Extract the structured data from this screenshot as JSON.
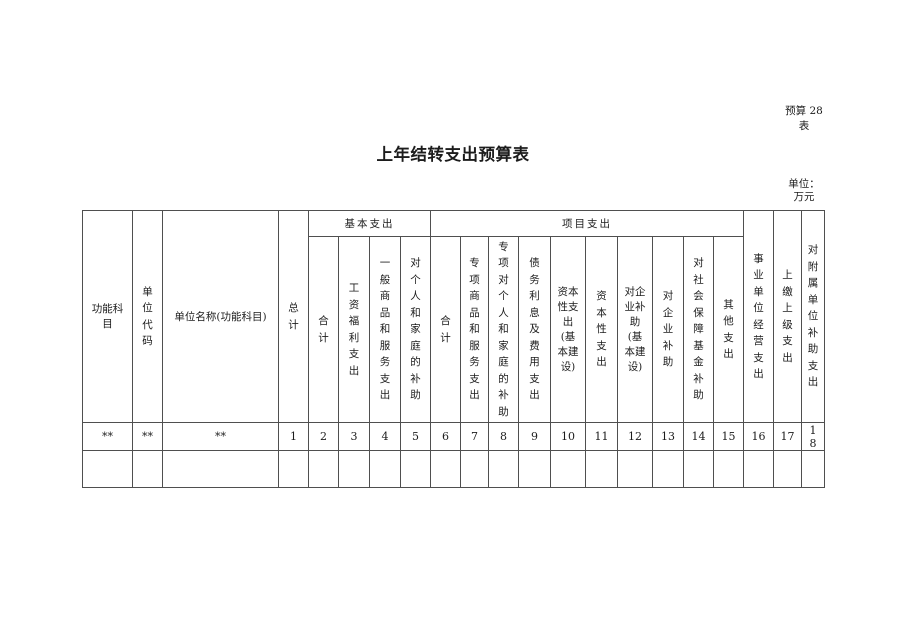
{
  "page": {
    "form_note": {
      "line1": "预算 28",
      "line2": "表"
    },
    "title": "上年结转支出预算表",
    "unit_note": {
      "line1": "单位：",
      "line2": "万元"
    }
  },
  "table": {
    "columns": [
      {
        "name": "functional-subject",
        "label": "功能科目",
        "orient": "wrap",
        "wrap_em": 3.3,
        "width": 50,
        "group": "",
        "group_id": ""
      },
      {
        "name": "unit-code",
        "label": "单位代码",
        "orient": "vertical",
        "width": 30,
        "group": "",
        "group_id": ""
      },
      {
        "name": "unit-name",
        "label": "单位名称(功能科目)",
        "orient": "horizontal",
        "width": 116,
        "group": "",
        "group_id": ""
      },
      {
        "name": "grand-total",
        "label": "总计",
        "orient": "vertical",
        "width": 30,
        "group": "",
        "group_id": ""
      },
      {
        "name": "basic-total",
        "label": "合计",
        "orient": "vertical",
        "width": 30,
        "group": "基本支出",
        "group_id": "basic-expenditure"
      },
      {
        "name": "wage-welfare-expenditure",
        "label": "工资福利支出",
        "orient": "vertical",
        "width": 31,
        "group": "基本支出",
        "group_id": "basic-expenditure"
      },
      {
        "name": "general-goods-services-expenditure",
        "label": "一般商品和服务支出",
        "orient": "vertical",
        "width": 31,
        "group": "基本支出",
        "group_id": "basic-expenditure"
      },
      {
        "name": "individual-family-subsidy",
        "label": "对个人和家庭的补助",
        "orient": "vertical",
        "width": 30,
        "group": "基本支出",
        "group_id": "basic-expenditure"
      },
      {
        "name": "project-total",
        "label": "合计",
        "orient": "vertical",
        "width": 30,
        "group": "项目支出",
        "group_id": "project-expenditure"
      },
      {
        "name": "special-goods-services-expenditure",
        "label": "专项商品和服务支出",
        "orient": "vertical",
        "width": 28,
        "group": "项目支出",
        "group_id": "project-expenditure"
      },
      {
        "name": "special-individual-family-subsidy",
        "label": "专项对个人和家庭的补助",
        "orient": "vertical",
        "width": 30,
        "group": "项目支出",
        "group_id": "project-expenditure"
      },
      {
        "name": "debt-interest-fee-expenditure",
        "label": "债务利息及费用支出",
        "orient": "vertical",
        "width": 32,
        "group": "项目支出",
        "group_id": "project-expenditure"
      },
      {
        "name": "capital-expenditure-basic-construction",
        "label": "资本性支出(基本建设)",
        "orient": "wrap",
        "wrap_em": 2.3,
        "width": 35,
        "group": "项目支出",
        "group_id": "project-expenditure"
      },
      {
        "name": "capital-expenditure",
        "label": "资本性支出",
        "orient": "vertical",
        "width": 32,
        "group": "项目支出",
        "group_id": "project-expenditure"
      },
      {
        "name": "enterprise-subsidy-basic-construction",
        "label": "对企业补助(基本建设)",
        "orient": "wrap",
        "wrap_em": 2.3,
        "width": 35,
        "group": "项目支出",
        "group_id": "project-expenditure"
      },
      {
        "name": "enterprise-subsidy",
        "label": "对企业补助",
        "orient": "vertical",
        "width": 31,
        "group": "项目支出",
        "group_id": "project-expenditure"
      },
      {
        "name": "social-security-fund-subsidy",
        "label": "对社会保障基金补助",
        "orient": "vertical",
        "width": 30,
        "group": "项目支出",
        "group_id": "project-expenditure"
      },
      {
        "name": "other-expenditure",
        "label": "其他支出",
        "orient": "vertical",
        "width": 30,
        "group": "项目支出",
        "group_id": "project-expenditure"
      },
      {
        "name": "business-unit-operating-expenditure",
        "label": "事业单位经营支出",
        "orient": "vertical",
        "width": 30,
        "group": "",
        "group_id": ""
      },
      {
        "name": "payment-to-superior-expenditure",
        "label": "上缴上级支出",
        "orient": "vertical",
        "width": 28,
        "group": "",
        "group_id": ""
      },
      {
        "name": "affiliated-unit-subsidy-expenditure",
        "label": "对附属单位补助支出",
        "orient": "vertical",
        "width": 23,
        "group": "",
        "group_id": "",
        "break_digits": true
      }
    ],
    "column_number_row": [
      "**",
      "**",
      "**",
      "1",
      "2",
      "3",
      "4",
      "5",
      "6",
      "7",
      "8",
      "9",
      "10",
      "11",
      "12",
      "13",
      "14",
      "15",
      "16",
      "17",
      "18"
    ],
    "body_rows": [
      [
        "",
        "",
        "",
        "",
        "",
        "",
        "",
        "",
        "",
        "",
        "",
        "",
        "",
        "",
        "",
        "",
        "",
        "",
        "",
        "",
        ""
      ]
    ]
  }
}
